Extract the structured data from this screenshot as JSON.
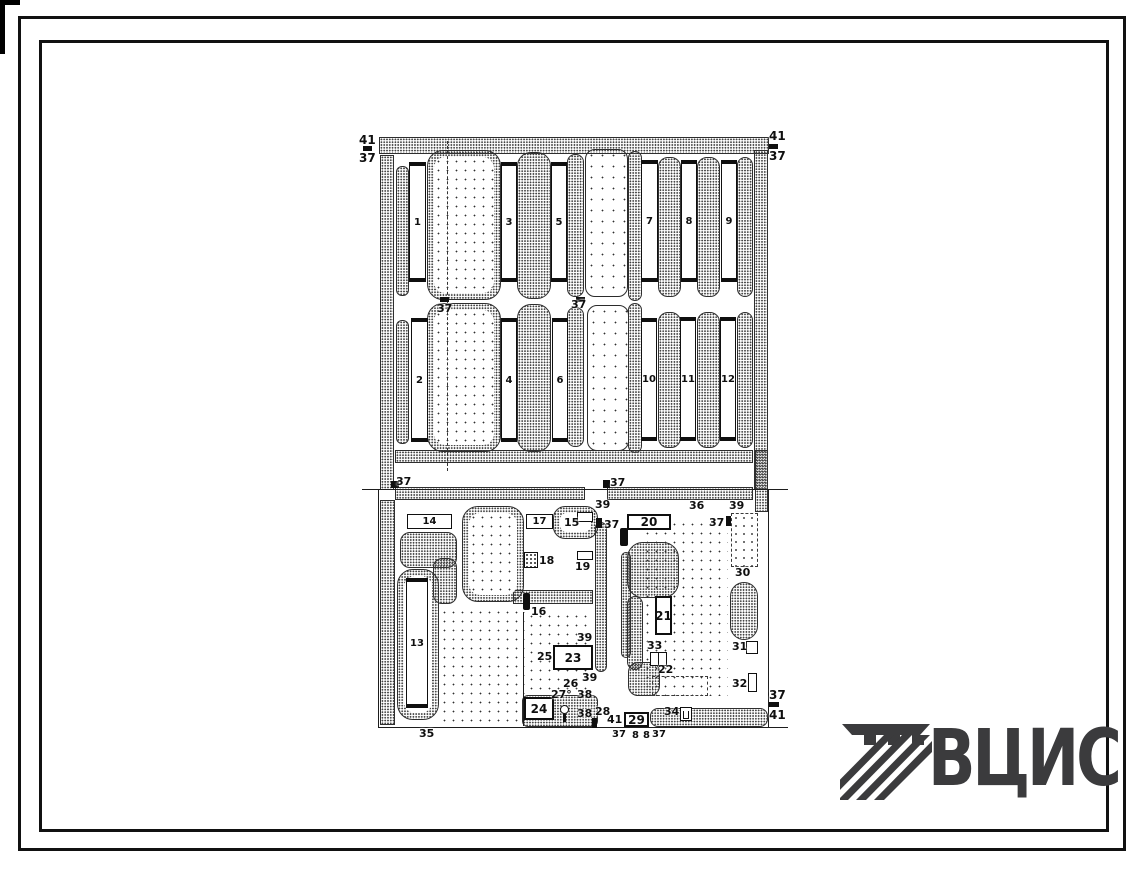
{
  "logo": {
    "text": "ВЦИС",
    "color": "#3b3b3d"
  },
  "drawing": {
    "ink": "#1d1d1d",
    "areas": [
      {
        "t": "sparse",
        "x": 440,
        "y": 608,
        "w": 85,
        "h": 117,
        "r": 0
      },
      {
        "t": "sparse",
        "x": 643,
        "y": 520,
        "w": 85,
        "h": 176,
        "r": 0
      },
      {
        "t": "sparse",
        "x": 527,
        "y": 612,
        "w": 64,
        "h": 82,
        "r": 0
      },
      {
        "t": "court",
        "x": 585,
        "y": 149,
        "w": 43,
        "h": 148,
        "r": 10
      },
      {
        "t": "court",
        "x": 587,
        "y": 305,
        "w": 42,
        "h": 146,
        "r": 10
      },
      {
        "t": "dense",
        "x": 379,
        "y": 137,
        "w": 390,
        "h": 17,
        "r": 0
      },
      {
        "t": "dense",
        "x": 380,
        "y": 155,
        "w": 14,
        "h": 335,
        "r": 0
      },
      {
        "t": "dense",
        "x": 754,
        "y": 150,
        "w": 14,
        "h": 340,
        "r": 0
      },
      {
        "t": "dense",
        "x": 396,
        "y": 166,
        "w": 13,
        "h": 130,
        "r": 6
      },
      {
        "t": "dense",
        "x": 517,
        "y": 152,
        "w": 34,
        "h": 147,
        "r": 14
      },
      {
        "t": "dense",
        "x": 567,
        "y": 154,
        "w": 17,
        "h": 143,
        "r": 8
      },
      {
        "t": "dense",
        "x": 628,
        "y": 151,
        "w": 14,
        "h": 150,
        "r": 7
      },
      {
        "t": "dense",
        "x": 658,
        "y": 157,
        "w": 23,
        "h": 140,
        "r": 10
      },
      {
        "t": "dense",
        "x": 697,
        "y": 157,
        "w": 23,
        "h": 140,
        "r": 10
      },
      {
        "t": "dense",
        "x": 737,
        "y": 157,
        "w": 16,
        "h": 140,
        "r": 8
      },
      {
        "t": "dense",
        "x": 396,
        "y": 320,
        "w": 13,
        "h": 124,
        "r": 6
      },
      {
        "t": "dense",
        "x": 517,
        "y": 304,
        "w": 34,
        "h": 148,
        "r": 14
      },
      {
        "t": "dense",
        "x": 567,
        "y": 307,
        "w": 17,
        "h": 140,
        "r": 8
      },
      {
        "t": "dense",
        "x": 628,
        "y": 303,
        "w": 14,
        "h": 150,
        "r": 7
      },
      {
        "t": "dense",
        "x": 658,
        "y": 312,
        "w": 23,
        "h": 136,
        "r": 10
      },
      {
        "t": "dense",
        "x": 697,
        "y": 312,
        "w": 23,
        "h": 136,
        "r": 10
      },
      {
        "t": "dense",
        "x": 737,
        "y": 312,
        "w": 16,
        "h": 136,
        "r": 8
      },
      {
        "t": "dense",
        "x": 395,
        "y": 450,
        "w": 358,
        "h": 13,
        "r": 0
      },
      {
        "t": "dense",
        "x": 395,
        "y": 487,
        "w": 190,
        "h": 13,
        "r": 0
      },
      {
        "t": "dense",
        "x": 607,
        "y": 487,
        "w": 146,
        "h": 13,
        "r": 0
      },
      {
        "t": "dense",
        "x": 380,
        "y": 500,
        "w": 15,
        "h": 225,
        "r": 0
      },
      {
        "t": "dense",
        "x": 400,
        "y": 532,
        "w": 57,
        "h": 36,
        "r": 10
      },
      {
        "t": "dense",
        "x": 433,
        "y": 558,
        "w": 24,
        "h": 46,
        "r": 9
      },
      {
        "t": "dense",
        "x": 513,
        "y": 590,
        "w": 80,
        "h": 14,
        "r": 0
      },
      {
        "t": "dense",
        "x": 595,
        "y": 522,
        "w": 12,
        "h": 150,
        "r": 6
      },
      {
        "t": "dense",
        "x": 621,
        "y": 552,
        "w": 10,
        "h": 106,
        "r": 5
      },
      {
        "t": "dense",
        "x": 650,
        "y": 708,
        "w": 118,
        "h": 19,
        "r": 8
      },
      {
        "t": "dense",
        "x": 522,
        "y": 695,
        "w": 76,
        "h": 32,
        "r": 6
      },
      {
        "t": "dense",
        "x": 755,
        "y": 450,
        "w": 13,
        "h": 62,
        "r": 0
      },
      {
        "t": "dense",
        "x": 627,
        "y": 542,
        "w": 52,
        "h": 56,
        "r": 16
      },
      {
        "t": "dense",
        "x": 627,
        "y": 596,
        "w": 16,
        "h": 74,
        "r": 8
      },
      {
        "t": "dense",
        "x": 628,
        "y": 662,
        "w": 32,
        "h": 34,
        "r": 10
      },
      {
        "t": "dense",
        "x": 730,
        "y": 582,
        "w": 28,
        "h": 58,
        "r": 14
      },
      {
        "t": "blob",
        "x": 427,
        "y": 150,
        "w": 74,
        "h": 150,
        "r": 16,
        "core": "sparse"
      },
      {
        "t": "blob",
        "x": 427,
        "y": 303,
        "w": 74,
        "h": 149,
        "r": 16,
        "core": "sparse"
      },
      {
        "t": "blob",
        "x": 462,
        "y": 506,
        "w": 62,
        "h": 96,
        "r": 16,
        "core": "sparse"
      },
      {
        "t": "blob",
        "x": 553,
        "y": 506,
        "w": 45,
        "h": 33,
        "r": 12,
        "core": "white"
      },
      {
        "t": "blob",
        "x": 397,
        "y": 569,
        "w": 42,
        "h": 151,
        "r": 16,
        "core": "white"
      }
    ],
    "lines": [
      {
        "o": "h",
        "x": 362,
        "y": 489,
        "len": 426
      },
      {
        "o": "h",
        "x": 378,
        "y": 727,
        "len": 410
      },
      {
        "o": "v",
        "x": 378,
        "y": 489,
        "len": 238
      },
      {
        "o": "v",
        "x": 768,
        "y": 489,
        "len": 238
      },
      {
        "o": "v",
        "x": 447,
        "y": 141,
        "len": 330,
        "dash": true
      },
      {
        "o": "v",
        "x": 523,
        "y": 612,
        "len": 114
      }
    ],
    "buildings": [
      {
        "n": "1",
        "x": 409,
        "y": 162,
        "w": 17,
        "h": 120,
        "dir": "v",
        "style": "caps"
      },
      {
        "n": "3",
        "x": 501,
        "y": 162,
        "w": 16,
        "h": 120,
        "dir": "v",
        "style": "caps"
      },
      {
        "n": "5",
        "x": 551,
        "y": 162,
        "w": 16,
        "h": 120,
        "dir": "v",
        "style": "caps"
      },
      {
        "n": "7",
        "x": 641,
        "y": 160,
        "w": 17,
        "h": 122,
        "dir": "v",
        "style": "caps"
      },
      {
        "n": "8",
        "x": 681,
        "y": 160,
        "w": 16,
        "h": 122,
        "dir": "v",
        "style": "caps"
      },
      {
        "n": "9",
        "x": 721,
        "y": 160,
        "w": 16,
        "h": 122,
        "dir": "v",
        "style": "caps"
      },
      {
        "n": "2",
        "x": 411,
        "y": 318,
        "w": 17,
        "h": 124,
        "dir": "v",
        "style": "caps"
      },
      {
        "n": "4",
        "x": 501,
        "y": 318,
        "w": 16,
        "h": 124,
        "dir": "v",
        "style": "caps"
      },
      {
        "n": "6",
        "x": 552,
        "y": 318,
        "w": 16,
        "h": 124,
        "dir": "v",
        "style": "caps"
      },
      {
        "n": "10",
        "x": 641,
        "y": 318,
        "w": 16,
        "h": 123,
        "dir": "v",
        "style": "caps"
      },
      {
        "n": "11",
        "x": 680,
        "y": 317,
        "w": 16,
        "h": 124,
        "dir": "v",
        "style": "caps"
      },
      {
        "n": "12",
        "x": 720,
        "y": 317,
        "w": 16,
        "h": 124,
        "dir": "v",
        "style": "caps"
      },
      {
        "n": "13",
        "x": 406,
        "y": 578,
        "w": 22,
        "h": 130,
        "dir": "v",
        "style": "caps"
      },
      {
        "n": "21",
        "x": 655,
        "y": 596,
        "w": 17,
        "h": 39,
        "dir": "v",
        "style": "thick"
      },
      {
        "n": "14",
        "x": 407,
        "y": 514,
        "w": 45,
        "h": 15,
        "dir": "h",
        "style": "plain"
      },
      {
        "n": "17",
        "x": 526,
        "y": 514,
        "w": 27,
        "h": 15,
        "dir": "h",
        "style": "plain"
      },
      {
        "n": "20",
        "x": 627,
        "y": 514,
        "w": 44,
        "h": 16,
        "dir": "h",
        "style": "thick"
      },
      {
        "n": "23",
        "x": 553,
        "y": 645,
        "w": 40,
        "h": 25,
        "dir": "h",
        "style": "thick"
      },
      {
        "n": "24",
        "x": 524,
        "y": 697,
        "w": 30,
        "h": 23,
        "dir": "h",
        "style": "thick"
      },
      {
        "n": "29",
        "x": 624,
        "y": 712,
        "w": 25,
        "h": 15,
        "dir": "h",
        "style": "thick"
      }
    ],
    "marks": [
      {
        "k": "tick",
        "x": 363,
        "y": 146,
        "w": 9,
        "h": 5
      },
      {
        "k": "tick",
        "x": 769,
        "y": 144,
        "w": 9,
        "h": 5
      },
      {
        "k": "tick",
        "x": 440,
        "y": 297,
        "w": 9,
        "h": 5
      },
      {
        "k": "tick",
        "x": 576,
        "y": 297,
        "w": 9,
        "h": 5
      },
      {
        "k": "tick",
        "x": 391,
        "y": 481,
        "w": 8,
        "h": 7
      },
      {
        "k": "tick",
        "x": 603,
        "y": 480,
        "w": 7,
        "h": 8
      },
      {
        "k": "tick",
        "x": 596,
        "y": 518,
        "w": 6,
        "h": 10
      },
      {
        "k": "tick",
        "x": 726,
        "y": 516,
        "w": 6,
        "h": 10
      },
      {
        "k": "tick",
        "x": 769,
        "y": 702,
        "w": 10,
        "h": 5
      },
      {
        "k": "tick",
        "x": 592,
        "y": 718,
        "w": 5,
        "h": 10
      },
      {
        "k": "bar",
        "x": 523,
        "y": 593,
        "w": 7,
        "h": 17
      },
      {
        "k": "bar",
        "x": 620,
        "y": 528,
        "w": 8,
        "h": 18
      },
      {
        "k": "box",
        "x": 577,
        "y": 551,
        "w": 16,
        "h": 9
      },
      {
        "k": "box",
        "x": 577,
        "y": 512,
        "w": 16,
        "h": 10
      },
      {
        "k": "box",
        "x": 746,
        "y": 641,
        "w": 12,
        "h": 13
      },
      {
        "k": "box",
        "x": 748,
        "y": 673,
        "w": 9,
        "h": 19
      },
      {
        "k": "box",
        "x": 650,
        "y": 652,
        "w": 9,
        "h": 14
      },
      {
        "k": "box",
        "x": 658,
        "y": 652,
        "w": 9,
        "h": 14
      },
      {
        "k": "hatch",
        "x": 524,
        "y": 552,
        "w": 14,
        "h": 16
      },
      {
        "k": "dashbox",
        "x": 652,
        "y": 676,
        "w": 56,
        "h": 20
      },
      {
        "k": "orchard",
        "x": 731,
        "y": 513,
        "w": 27,
        "h": 54
      },
      {
        "k": "tub",
        "x": 680,
        "y": 707,
        "w": 12,
        "h": 14
      },
      {
        "k": "lamp",
        "x": 559,
        "y": 705,
        "w": 10,
        "h": 17
      }
    ],
    "labels": [
      {
        "t": "41",
        "x": 359,
        "y": 134,
        "s": 12
      },
      {
        "t": "37",
        "x": 359,
        "y": 152,
        "s": 12
      },
      {
        "t": "41",
        "x": 769,
        "y": 130,
        "s": 12
      },
      {
        "t": "37",
        "x": 769,
        "y": 150,
        "s": 12
      },
      {
        "t": "37",
        "x": 437,
        "y": 303
      },
      {
        "t": "37",
        "x": 571,
        "y": 299
      },
      {
        "t": "37",
        "x": 396,
        "y": 476
      },
      {
        "t": "37",
        "x": 610,
        "y": 477
      },
      {
        "t": "39",
        "x": 595,
        "y": 499
      },
      {
        "t": "36",
        "x": 689,
        "y": 500
      },
      {
        "t": "39",
        "x": 729,
        "y": 500
      },
      {
        "t": "37",
        "x": 604,
        "y": 519
      },
      {
        "t": "37",
        "x": 709,
        "y": 517
      },
      {
        "t": "15",
        "x": 564,
        "y": 517
      },
      {
        "t": "30",
        "x": 735,
        "y": 567
      },
      {
        "t": "18",
        "x": 539,
        "y": 555
      },
      {
        "t": "19",
        "x": 575,
        "y": 561
      },
      {
        "t": "16",
        "x": 531,
        "y": 606
      },
      {
        "t": "25",
        "x": 537,
        "y": 651
      },
      {
        "t": "39",
        "x": 577,
        "y": 632
      },
      {
        "t": "39",
        "x": 582,
        "y": 672
      },
      {
        "t": "26",
        "x": 563,
        "y": 678
      },
      {
        "t": "27°",
        "x": 551,
        "y": 689
      },
      {
        "t": "38",
        "x": 577,
        "y": 689
      },
      {
        "t": "38",
        "x": 577,
        "y": 708
      },
      {
        "t": "28",
        "x": 595,
        "y": 706
      },
      {
        "t": "41",
        "x": 607,
        "y": 714
      },
      {
        "t": "34",
        "x": 664,
        "y": 706
      },
      {
        "t": "33",
        "x": 647,
        "y": 640
      },
      {
        "t": "22",
        "x": 658,
        "y": 664
      },
      {
        "t": "31",
        "x": 732,
        "y": 641
      },
      {
        "t": "32",
        "x": 732,
        "y": 678
      },
      {
        "t": "37",
        "x": 769,
        "y": 689,
        "s": 12
      },
      {
        "t": "41",
        "x": 769,
        "y": 709,
        "s": 12
      },
      {
        "t": "35",
        "x": 419,
        "y": 728
      },
      {
        "t": "37",
        "x": 612,
        "y": 730,
        "s": 10
      },
      {
        "t": "8",
        "x": 632,
        "y": 731,
        "s": 10
      },
      {
        "t": "8",
        "x": 643,
        "y": 731,
        "s": 10
      },
      {
        "t": "37",
        "x": 652,
        "y": 730,
        "s": 10
      }
    ]
  }
}
